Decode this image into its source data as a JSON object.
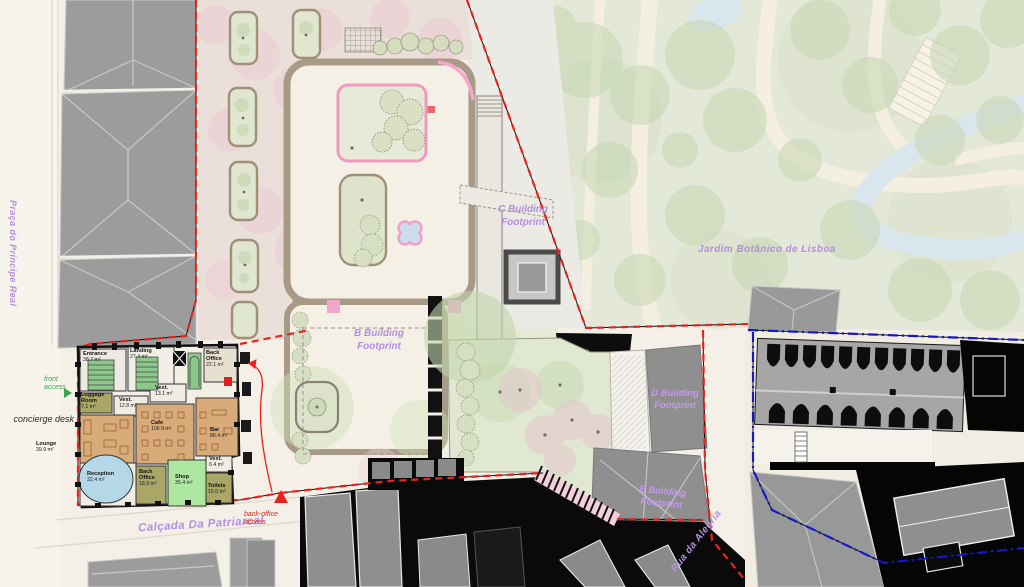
{
  "streets": {
    "praca_do_principe_real": "Praça do Príncipe Real",
    "calcada_da_patriarcal": "Calçada Da Patriarcal",
    "rua_da_alegria": "Rua da Alegria"
  },
  "places": {
    "jardim_botanico": "Jardim Botânico de Lisboa"
  },
  "footprints": {
    "b": "B Building Footprint",
    "c": "C Building Footprint",
    "d": "D Building Footprint",
    "e": "E Building Footprint"
  },
  "annotations": {
    "front_access": "front access",
    "concierge_desk": "concierge desk",
    "back_office_access": "back-office access"
  },
  "floorplan": {
    "rooms": [
      {
        "name": "Entrance",
        "area": "38.7 m²"
      },
      {
        "name": "Landing",
        "area": "27.4 m²"
      },
      {
        "name": "Back Office",
        "area": "22.1 m²"
      },
      {
        "name": "Vest.",
        "area": "13.1 m²"
      },
      {
        "name": "Luggage Room",
        "area": "7.1 m²"
      },
      {
        "name": "Vest.",
        "area": "12.8 m²"
      },
      {
        "name": "Cafe",
        "area": "106.9 m²"
      },
      {
        "name": "Bar",
        "area": "88.4 m²"
      },
      {
        "name": "Lounge",
        "area": "39.9 m²"
      },
      {
        "name": "Reception",
        "area": "32.4 m²"
      },
      {
        "name": "Back Office",
        "area": "18.9 m²"
      },
      {
        "name": "Shop",
        "area": "35.4 m²"
      },
      {
        "name": "Vest.",
        "area": "6.4 m²"
      },
      {
        "name": "Toilets",
        "area": "15.0 m²"
      }
    ]
  },
  "colors": {
    "boundary_red": "#e8231e",
    "boundary_blue": "#1518c8",
    "label_purple": "#b48fe0",
    "access_green": "#3da653",
    "cafe_fill": "#d9ab79",
    "shop_fill": "#aee8a0",
    "reception_fill": "#b5d8e8",
    "stairs_green": "#8cc88a",
    "service_olive": "#aaa666"
  }
}
